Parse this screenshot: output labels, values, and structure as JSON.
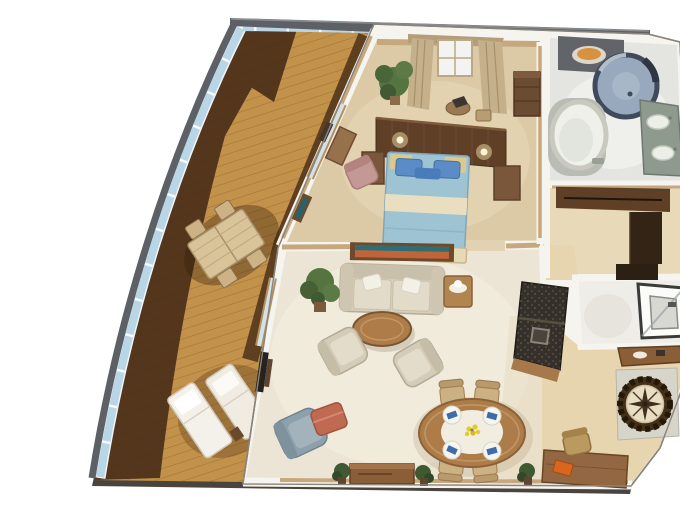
{
  "scene": {
    "kind": "3d-floor-plan-render",
    "subject": "cruise-ship-suite-with-wraparound-veranda",
    "view": "isometric-top-down",
    "background": "#ffffff"
  },
  "palette": {
    "hull_gray": "#5d6165",
    "glass_blue": "#b9d6e6",
    "glass_mullion": "#f2f8fb",
    "deck_tan": "#c2914a",
    "deck_dark": "#53361b",
    "slab_dark": "#4a443e",
    "wall_white": "#f6f4ef",
    "wall_tan": "#c7a87e",
    "bedroom_floor": "#dccaa6",
    "living_floor": "#ece5d5",
    "foyer_floor": "#e6d5af",
    "bath_floor": "#e4e4e0",
    "closet_floor": "#e8d9b8",
    "wood_dark": "#5f4026",
    "wood_mid": "#8a5f38",
    "wood_light": "#ad7c49",
    "bed_duvet_blue": "#9ec4d4",
    "bed_pillow_blue": "#5b8cc8",
    "bed_cream": "#e9dfc0",
    "sofa_cream": "#d6cdba",
    "cushion_cream": "#e2dbc9",
    "chair_gray": "#8da0ab",
    "ottoman_red": "#c06a52",
    "plant_green": "#56743f",
    "tub_white": "#eff0ea",
    "shower_glass": "#98a9bd",
    "vanity_green": "#8e9a8e",
    "sink_orange": "#d8913e",
    "granite_dark": "#36302a",
    "compass_ring": "#443019",
    "compass_face": "#e9dec4",
    "napkin_blue": "#3e6cab",
    "flower_yellow": "#e6c92e",
    "art_orange": "#c2643a",
    "art_teal": "#2f6d74",
    "pink_chair": "#c49894",
    "desk_orange": "#d9661f"
  },
  "rooms": [
    {
      "id": "veranda",
      "items": [
        "teak-decking",
        "glass-railing",
        "outdoor-table",
        "outdoor-chairs",
        "sun-loungers"
      ]
    },
    {
      "id": "bedroom",
      "items": [
        "king-bed",
        "headboard-wall",
        "sconces",
        "nightstands",
        "dresser",
        "vanity",
        "pink-armchair",
        "curtained-window",
        "plant"
      ]
    },
    {
      "id": "master-bathroom",
      "items": [
        "round-tub",
        "cylinder-shower",
        "double-vanity",
        "vessel-sink-counter"
      ]
    },
    {
      "id": "walk-in-closet",
      "items": [
        "wardrobe-l-unit"
      ]
    },
    {
      "id": "guest-shower-room",
      "items": [
        "glass-shower"
      ]
    },
    {
      "id": "living-room",
      "items": [
        "sofa",
        "wall-art",
        "coffee-table",
        "armchair",
        "armchair",
        "gray-armchair",
        "red-ottoman",
        "side-table-lamp",
        "sideboard",
        "plants",
        "wet-bar",
        "wall-tv"
      ]
    },
    {
      "id": "dining-area",
      "items": [
        "oval-table",
        "four-chairs",
        "place-settings",
        "flower-centerpiece"
      ]
    },
    {
      "id": "entry-foyer",
      "items": [
        "compass-rose-inlay",
        "console-table",
        "writing-desk",
        "desk-chair"
      ]
    }
  ]
}
